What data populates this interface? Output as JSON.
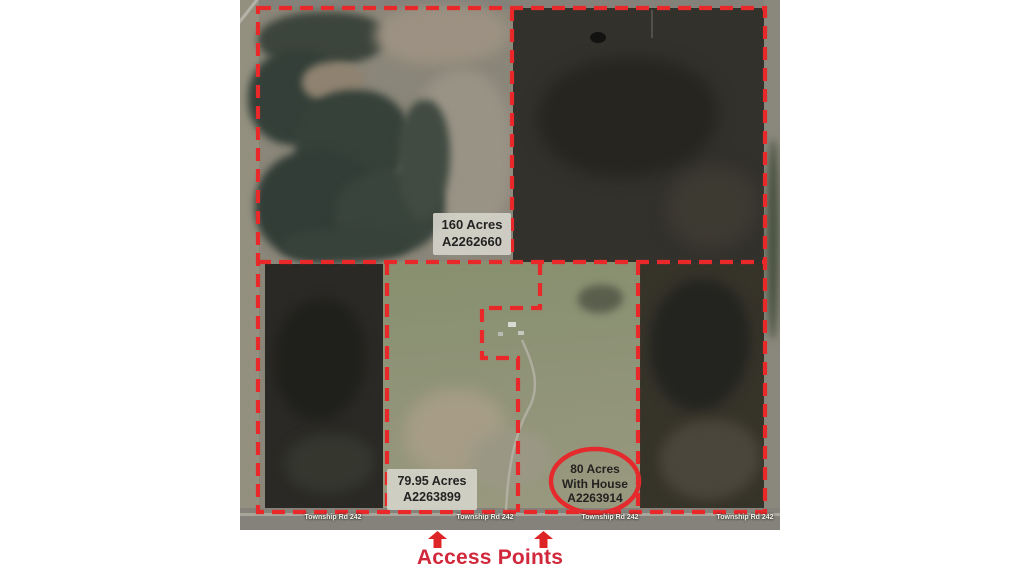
{
  "map": {
    "parcels": [
      {
        "lines": [
          "160 Acres",
          "A2262660"
        ]
      },
      {
        "lines": [
          "79.95 Acres",
          "A2263899"
        ]
      },
      {
        "lines": [
          "80 Acres",
          "With House",
          "A2263914"
        ]
      }
    ],
    "road_labels": [
      "Township Rd 242",
      "Township Rd 242",
      "Township Rd 242",
      "Township Rd 242"
    ],
    "colors": {
      "boundary_red": "#e9282a",
      "circle_red": "#e42a2c",
      "label_box_bg": "#d4d2c9",
      "label_text": "#232322"
    }
  },
  "annotation": {
    "access_points_label": "Access Points",
    "arrow_color": "#dd2528",
    "text_color": "#d1293b"
  }
}
